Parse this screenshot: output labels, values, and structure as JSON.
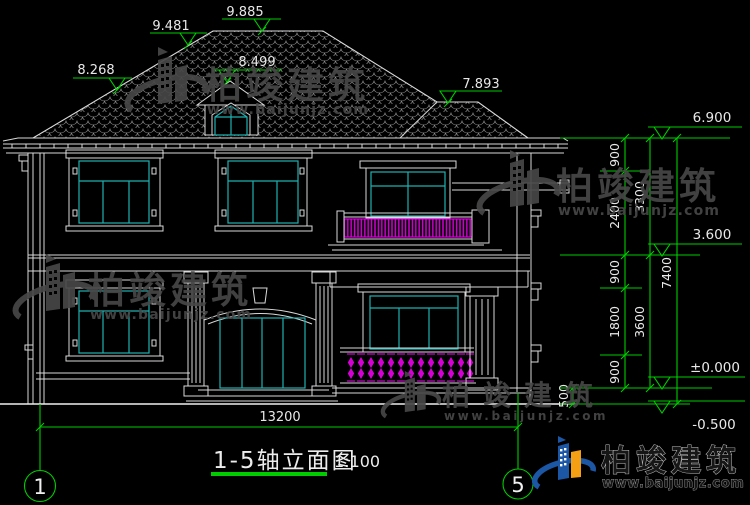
{
  "meta": {
    "type": "architectural-elevation-cad-drawing",
    "background": "#000000"
  },
  "colors": {
    "line": "#d9d9d9",
    "glazing_cyan": "#1fb0b0",
    "baluster_magenta": "#d400d4",
    "dimension_green": "#00cc00",
    "text": "#e8e8e8",
    "watermark_gray": "#474747",
    "logo_blue": "#1b57a5",
    "logo_orange": "#f49f14",
    "title_underline": "#00cc00"
  },
  "annotations": {
    "roof_levels": {
      "ridge": "9.885",
      "left_upper": "9.481",
      "left_lower": "8.268",
      "dormer": "8.499",
      "right_ridge": "7.893"
    },
    "right_levels": {
      "eave": "6.900",
      "second_floor": "3.600",
      "ground": "±0.000",
      "site": "-0.500"
    },
    "chain_segments": [
      "900",
      "2400",
      "900",
      "1800",
      "900"
    ],
    "chain_totals": {
      "upper": "3300",
      "lower": "3600",
      "overall": "7400",
      "below_ground": "500"
    },
    "overall_width": "13200"
  },
  "titleblock": {
    "title": "1-5轴立面图",
    "scale": "1:100"
  },
  "axes": {
    "left": "1",
    "right": "5"
  },
  "watermark": {
    "brand": "柏竣建筑",
    "url": "www.baijunjz.com"
  }
}
